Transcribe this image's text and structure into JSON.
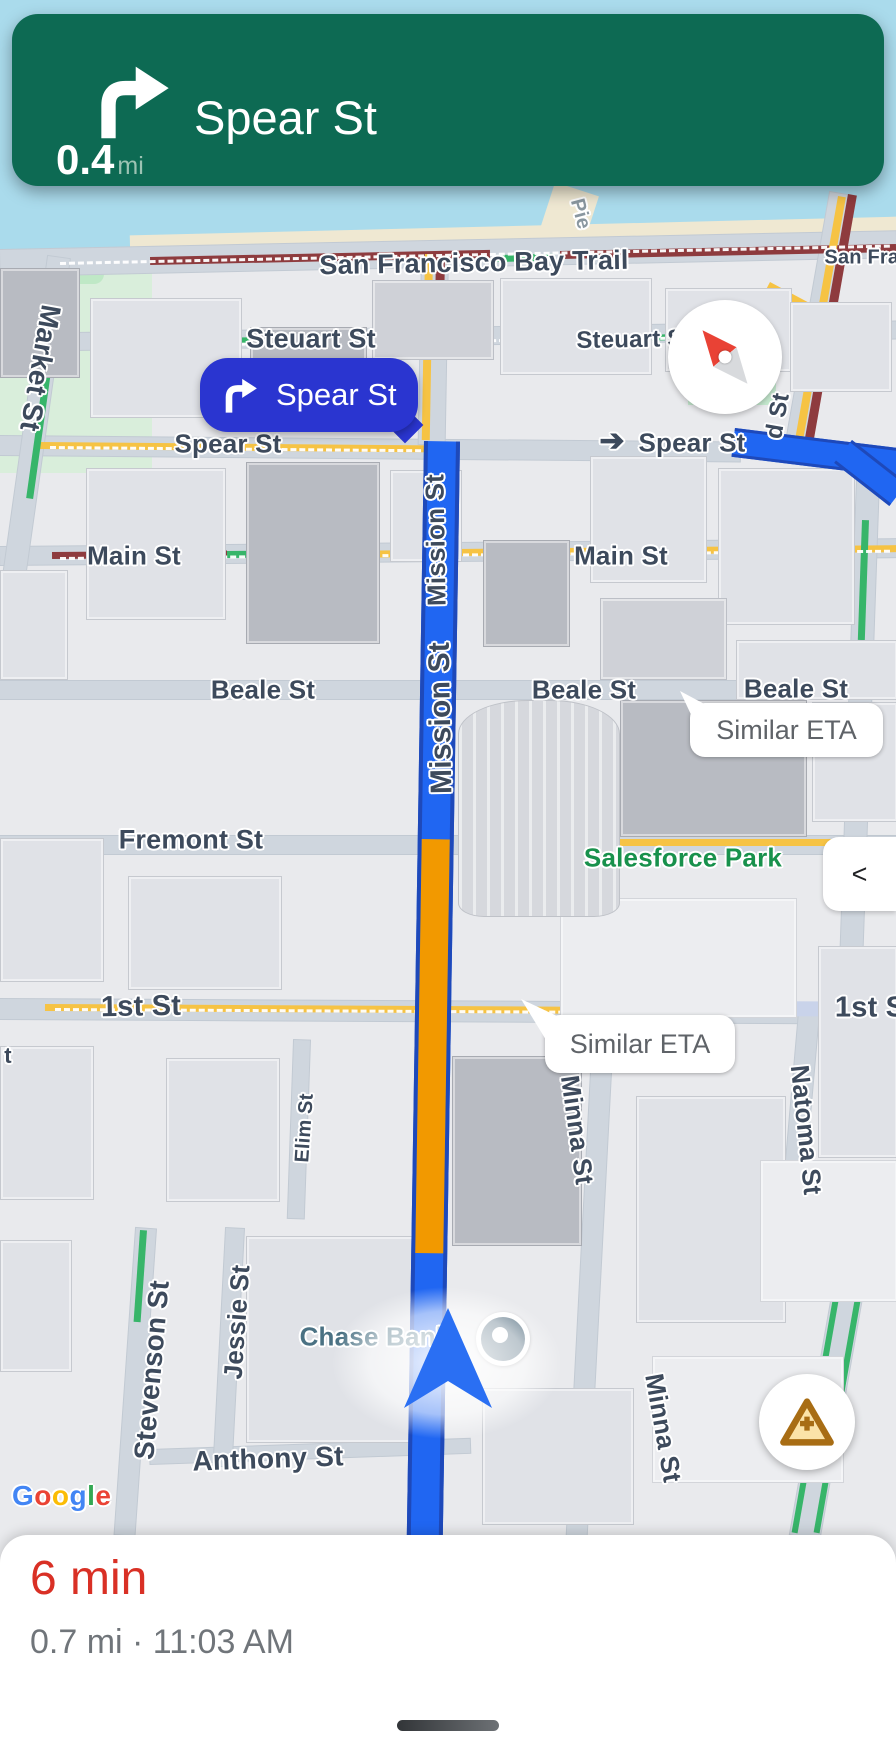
{
  "nav_banner": {
    "distance_value": "0.4",
    "distance_unit": "mi",
    "street": "Spear St"
  },
  "turn_callout": {
    "street": "Spear St"
  },
  "eta_bubbles": [
    "Similar ETA",
    "Similar ETA"
  ],
  "controls": {
    "collapse_chevron": "<"
  },
  "bottom_sheet": {
    "eta": "6 min",
    "trip_details": "0.7 mi · 11:03 AM"
  },
  "google_logo": [
    {
      "ch": "G",
      "c": "#4285F4"
    },
    {
      "ch": "o",
      "c": "#EA4335"
    },
    {
      "ch": "o",
      "c": "#FBBC05"
    },
    {
      "ch": "g",
      "c": "#4285F4"
    },
    {
      "ch": "l",
      "c": "#34A853"
    },
    {
      "ch": "e",
      "c": "#EA4335"
    }
  ],
  "map_labels": [
    {
      "id": "market-st",
      "text": "Market St",
      "x": 40,
      "y": 368,
      "rot": 100,
      "size": 28
    },
    {
      "id": "pier",
      "text": "Pie",
      "x": 580,
      "y": 214,
      "rot": 75,
      "size": 20,
      "cls": "muted"
    },
    {
      "id": "sf-bay-trail",
      "text": "San Francisco Bay Trail",
      "x": 474,
      "y": 263,
      "rot": -1,
      "size": 27
    },
    {
      "id": "san-fran",
      "text": "San Fran",
      "x": 868,
      "y": 258,
      "rot": 0,
      "size": 20
    },
    {
      "id": "steuart-st-left",
      "text": "Steuart St",
      "x": 311,
      "y": 339,
      "rot": 0,
      "size": 27
    },
    {
      "id": "steuart-st-right",
      "text": "Steuart St",
      "x": 634,
      "y": 340,
      "rot": -1,
      "size": 24
    },
    {
      "id": "spear-st-left",
      "text": "Spear St",
      "x": 228,
      "y": 444,
      "rot": 0,
      "size": 26
    },
    {
      "id": "spear-turn-arrow",
      "text": "➔",
      "x": 612,
      "y": 441,
      "rot": 0,
      "size": 30,
      "cls": "arrow"
    },
    {
      "id": "spear-st-right",
      "text": "Spear St",
      "x": 692,
      "y": 443,
      "rot": 0,
      "size": 26
    },
    {
      "id": "howard-st-fragment",
      "text": "d St",
      "x": 778,
      "y": 416,
      "rot": -80,
      "size": 24
    },
    {
      "id": "main-st-left",
      "text": "Main St",
      "x": 134,
      "y": 556,
      "rot": 0,
      "size": 26
    },
    {
      "id": "main-st-right",
      "text": "Main St",
      "x": 621,
      "y": 556,
      "rot": 0,
      "size": 26
    },
    {
      "id": "beale-st-left",
      "text": "Beale St",
      "x": 263,
      "y": 690,
      "rot": 0,
      "size": 26
    },
    {
      "id": "beale-st-mid",
      "text": "Beale St",
      "x": 584,
      "y": 690,
      "rot": 0,
      "size": 26
    },
    {
      "id": "beale-st-right",
      "text": "Beale St",
      "x": 796,
      "y": 689,
      "rot": 0,
      "size": 26
    },
    {
      "id": "fremont-st",
      "text": "Fremont St",
      "x": 191,
      "y": 840,
      "rot": 0,
      "size": 27
    },
    {
      "id": "salesforce-park",
      "text": "Salesforce Park",
      "x": 683,
      "y": 858,
      "rot": 0,
      "size": 26,
      "cls": "park"
    },
    {
      "id": "mission-st-upper",
      "text": "Mission St",
      "x": 436,
      "y": 540,
      "rot": -91,
      "size": 26
    },
    {
      "id": "mission-st",
      "text": "Mission St",
      "x": 441,
      "y": 718,
      "rot": -91,
      "size": 30
    },
    {
      "id": "first-st-left",
      "text": "1st St",
      "x": 141,
      "y": 1007,
      "rot": -1,
      "size": 29
    },
    {
      "id": "first-st-right",
      "text": "1st St",
      "x": 875,
      "y": 1008,
      "rot": 0,
      "size": 29
    },
    {
      "id": "natoma-st",
      "text": "Natoma St",
      "x": 806,
      "y": 1130,
      "rot": 84,
      "size": 26
    },
    {
      "id": "minna-st-upper",
      "text": "Minna St",
      "x": 577,
      "y": 1130,
      "rot": 82,
      "size": 26
    },
    {
      "id": "minna-st-lower",
      "text": "Minna St",
      "x": 663,
      "y": 1428,
      "rot": 80,
      "size": 26
    },
    {
      "id": "elim-st",
      "text": "Elim St",
      "x": 305,
      "y": 1128,
      "rot": -86,
      "size": 20
    },
    {
      "id": "jessie-st",
      "text": "Jessie St",
      "x": 237,
      "y": 1322,
      "rot": -86,
      "size": 26
    },
    {
      "id": "stevenson-st",
      "text": "Stevenson St",
      "x": 152,
      "y": 1370,
      "rot": -85,
      "size": 28
    },
    {
      "id": "market-st-fragment",
      "text": "t",
      "x": 8,
      "y": 1056,
      "rot": 0,
      "size": 22
    },
    {
      "id": "anthony-st",
      "text": "Anthony St",
      "x": 268,
      "y": 1459,
      "rot": -2,
      "size": 28
    },
    {
      "id": "chase-bank",
      "text": "Chase Bank",
      "x": 375,
      "y": 1337,
      "rot": 0,
      "size": 26,
      "cls": "poi"
    }
  ],
  "colors": {
    "banner": "#0d6a53",
    "callout": "#2a35d0",
    "route": "#2066f2",
    "routeb": "#1e49ba",
    "torange": "#f29900",
    "tred": "#8e3b3e",
    "tyellow": "#f6c344",
    "tgreen": "#37b56a",
    "water": "#aadbec",
    "navy": "#3d4a5c",
    "park": "#18914c",
    "poi": "#4a7183",
    "eta": "#d93025"
  }
}
